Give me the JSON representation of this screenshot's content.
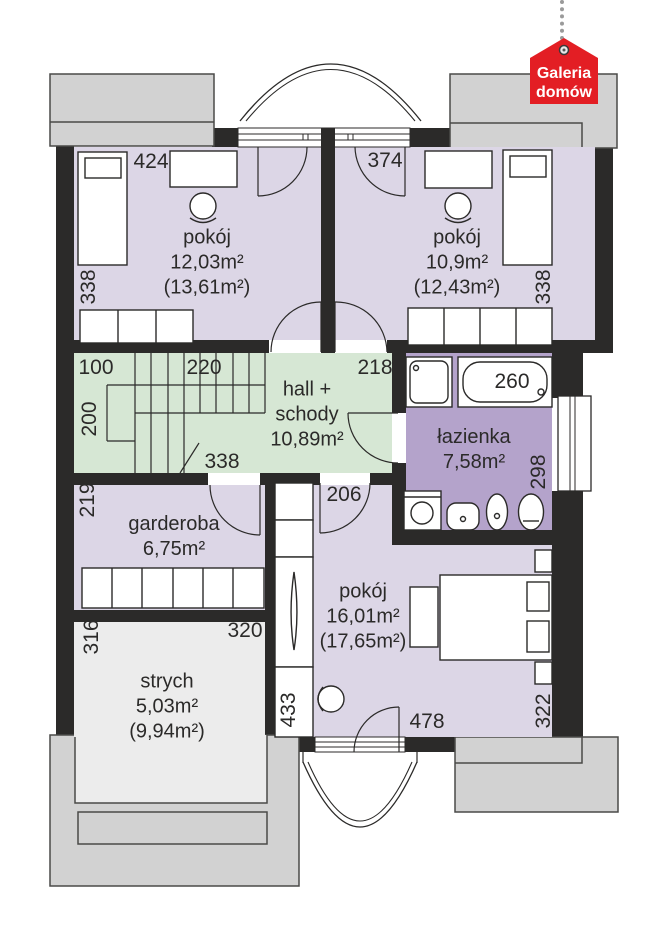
{
  "logo": {
    "line1": "Galeria",
    "line2": "domów"
  },
  "rooms": {
    "pokoj_tl": {
      "name": "pokój",
      "area": "12,03m²",
      "area_gross": "(13,61m²)"
    },
    "pokoj_tr": {
      "name": "pokój",
      "area": "10,9m²",
      "area_gross": "(12,43m²)"
    },
    "hall": {
      "name_line1": "hall +",
      "name_line2": "schody",
      "area": "10,89m²"
    },
    "lazienka": {
      "name": "łazienka",
      "area": "7,58m²"
    },
    "garderoba": {
      "name": "garderoba",
      "area": "6,75m²"
    },
    "pokoj_b": {
      "name": "pokój",
      "area": "16,01m²",
      "area_gross": "(17,65m²)"
    },
    "strych": {
      "name": "strych",
      "area": "5,03m²",
      "area_gross": "(9,94m²)"
    }
  },
  "dimensions": {
    "d424": "424",
    "d374": "374",
    "d338_tl": "338",
    "d338_tr": "338",
    "d100": "100",
    "d220": "220",
    "d218": "218",
    "d200": "200",
    "d338_hall": "338",
    "d260": "260",
    "d298": "298",
    "d219": "219",
    "d206": "206",
    "d316": "316",
    "d320": "320",
    "d433": "433",
    "d478": "478",
    "d322": "322"
  },
  "colors": {
    "wall": "#2b2a29",
    "room_lavender": "#dcd6e6",
    "hall_green": "#d6e7d4",
    "bathroom_purple": "#b4a3cb",
    "floor_light": "#ececec",
    "roof_gray": "#d2d2d2",
    "logo_red": "#e31e24",
    "line": "#2b2a29"
  }
}
